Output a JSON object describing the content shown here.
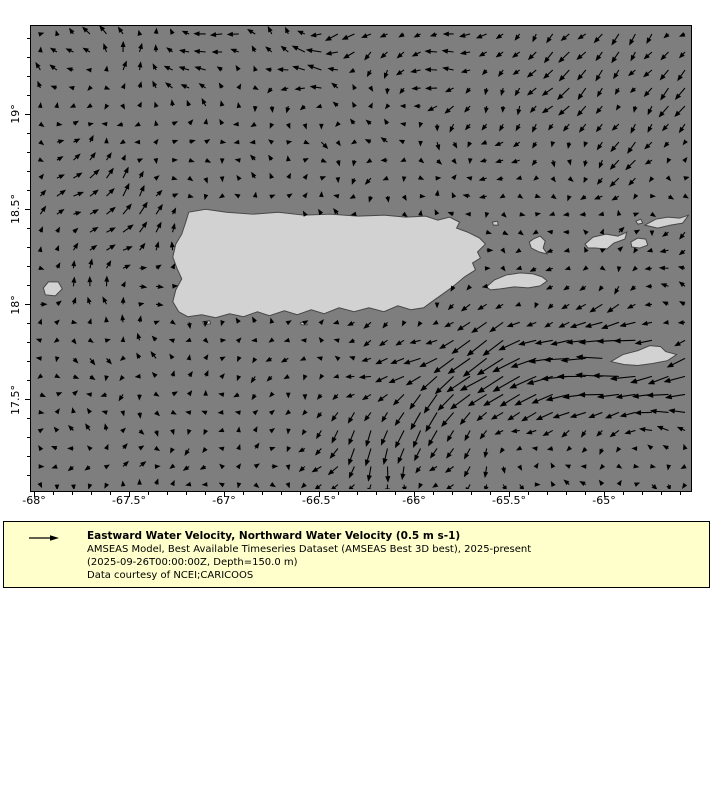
{
  "figure": {
    "width": 720,
    "height": 800,
    "background": "#ffffff"
  },
  "map": {
    "ocean_color": "#7e7e7e",
    "land_color": "#d2d2d2",
    "land_edge_color": "#474747",
    "frame_color": "#000000",
    "left": 30,
    "top": 25,
    "width": 660,
    "height": 465
  },
  "legend": {
    "background": "#ffffcc",
    "border_color": "#000000",
    "arrow_icon": "quiver-reference-arrow",
    "title": "Eastward Water Velocity, Northward Water Velocity (0.5 m s-1)",
    "lines": [
      "AMSEAS Model, Best Available Timeseries Dataset (AMSEAS Best 3D best), 2025-present",
      "(2025-09-26T00:00:00Z, Depth=150.0 m)",
      "Data courtesy of NCEI;CARICOOS"
    ]
  },
  "chart_data": {
    "type": "quiver-map",
    "projection": "lon-lat",
    "x_range": [
      -68.05,
      -64.55
    ],
    "y_range": [
      17.02,
      19.46
    ],
    "reference_vector": "0.5 m s-1",
    "arrow_color": "#000000",
    "x_axis": {
      "major_ticks": [
        {
          "label": "-68°",
          "px": 3
        },
        {
          "label": "-67.5°",
          "px": 98
        },
        {
          "label": "-67°",
          "px": 193
        },
        {
          "label": "-66.5°",
          "px": 288
        },
        {
          "label": "-66°",
          "px": 383
        },
        {
          "label": "-65.5°",
          "px": 478
        },
        {
          "label": "-65°",
          "px": 573
        }
      ],
      "minor_step": 19,
      "minor_start": 3,
      "major_len": 5,
      "minor_len": 3
    },
    "y_axis": {
      "major_ticks": [
        {
          "label": "19°",
          "px": 88
        },
        {
          "label": "18.5°",
          "px": 183
        },
        {
          "label": "18°",
          "px": 279
        },
        {
          "label": "17.5°",
          "px": 374
        }
      ],
      "minor_step": 19,
      "minor_start": 12,
      "major_len": 5,
      "minor_len": 3
    },
    "grid": {
      "x0": 9,
      "y0": 8,
      "dx": 16.6,
      "dy": 18.1,
      "cols": 40,
      "rows": 26
    },
    "flow_features": [
      {
        "name": "north-westward-band",
        "cx": 280,
        "cy": 22,
        "sx": 150,
        "sy": 34,
        "u": -9,
        "v": 0.5
      },
      {
        "name": "northeast-sw-flow",
        "cx": 590,
        "cy": 60,
        "sx": 120,
        "sy": 65,
        "u": -6.5,
        "v": 9
      },
      {
        "name": "northwest-northward",
        "cx": 125,
        "cy": 28,
        "sx": 70,
        "sy": 32,
        "u": 0.5,
        "v": -6.5
      },
      {
        "name": "mona-passage-ne",
        "cx": 85,
        "cy": 205,
        "sx": 55,
        "sy": 50,
        "u": 6,
        "v": -8.5
      },
      {
        "name": "west-eastward",
        "cx": 42,
        "cy": 168,
        "sx": 40,
        "sy": 26,
        "u": 5,
        "v": -0.5
      },
      {
        "name": "caribbean-westward-jet",
        "cx": 545,
        "cy": 342,
        "sx": 135,
        "sy": 30,
        "u": -23,
        "v": 2.5
      },
      {
        "name": "jet-southward-feed",
        "cx": 448,
        "cy": 352,
        "sx": 48,
        "sy": 55,
        "u": -5,
        "v": 13
      },
      {
        "name": "south-central-outflow",
        "cx": 352,
        "cy": 424,
        "sx": 52,
        "sy": 40,
        "u": -6,
        "v": 14
      },
      {
        "name": "southeast-westward",
        "cx": 604,
        "cy": 384,
        "sx": 78,
        "sy": 24,
        "u": -9,
        "v": 1
      },
      {
        "name": "east-mid-westward",
        "cx": 598,
        "cy": 282,
        "sx": 80,
        "sy": 38,
        "u": -5.5,
        "v": 2
      }
    ],
    "noise": {
      "amp1": 3.1,
      "amp2": 2.1,
      "jitter": 2.6,
      "min_len": 2.6,
      "max_len": 30
    },
    "land_polygons": [
      {
        "name": "puerto-rico",
        "mask": true,
        "points": [
          [
            158,
            187
          ],
          [
            175,
            184
          ],
          [
            196,
            187
          ],
          [
            222,
            189
          ],
          [
            248,
            187
          ],
          [
            274,
            190
          ],
          [
            300,
            189
          ],
          [
            328,
            191
          ],
          [
            354,
            190
          ],
          [
            376,
            192
          ],
          [
            396,
            191
          ],
          [
            408,
            195
          ],
          [
            420,
            192
          ],
          [
            430,
            197
          ],
          [
            427,
            203
          ],
          [
            438,
            207
          ],
          [
            450,
            213
          ],
          [
            456,
            219
          ],
          [
            448,
            227
          ],
          [
            451,
            233
          ],
          [
            443,
            238
          ],
          [
            446,
            245
          ],
          [
            435,
            252
          ],
          [
            423,
            262
          ],
          [
            412,
            270
          ],
          [
            402,
            277
          ],
          [
            394,
            283
          ],
          [
            381,
            285
          ],
          [
            368,
            281
          ],
          [
            354,
            287
          ],
          [
            339,
            283
          ],
          [
            324,
            287
          ],
          [
            309,
            283
          ],
          [
            294,
            289
          ],
          [
            281,
            285
          ],
          [
            267,
            290
          ],
          [
            254,
            286
          ],
          [
            239,
            291
          ],
          [
            227,
            287
          ],
          [
            213,
            292
          ],
          [
            199,
            289
          ],
          [
            185,
            293
          ],
          [
            171,
            290
          ],
          [
            157,
            292
          ],
          [
            148,
            287
          ],
          [
            142,
            277
          ],
          [
            145,
            265
          ],
          [
            151,
            254
          ],
          [
            146,
            243
          ],
          [
            142,
            232
          ],
          [
            145,
            219
          ],
          [
            151,
            209
          ],
          [
            155,
            197
          ]
        ]
      },
      {
        "name": "vieques",
        "mask": true,
        "points": [
          [
            457,
            262
          ],
          [
            465,
            255
          ],
          [
            477,
            250
          ],
          [
            491,
            248
          ],
          [
            504,
            249
          ],
          [
            513,
            252
          ],
          [
            518,
            256
          ],
          [
            511,
            261
          ],
          [
            499,
            263
          ],
          [
            485,
            262
          ],
          [
            471,
            264
          ],
          [
            461,
            265
          ]
        ]
      },
      {
        "name": "culebra",
        "mask": true,
        "points": [
          [
            504,
            214
          ],
          [
            511,
            211
          ],
          [
            516,
            216
          ],
          [
            514,
            223
          ],
          [
            518,
            229
          ],
          [
            510,
            227
          ],
          [
            502,
            223
          ],
          [
            500,
            217
          ]
        ]
      },
      {
        "name": "st-thomas",
        "mask": true,
        "points": [
          [
            556,
            219
          ],
          [
            564,
            212
          ],
          [
            577,
            209
          ],
          [
            589,
            211
          ],
          [
            598,
            207
          ],
          [
            596,
            214
          ],
          [
            585,
            218
          ],
          [
            578,
            224
          ],
          [
            566,
            223
          ],
          [
            559,
            223
          ]
        ]
      },
      {
        "name": "st-john",
        "mask": true,
        "points": [
          [
            602,
            217
          ],
          [
            609,
            213
          ],
          [
            617,
            214
          ],
          [
            619,
            220
          ],
          [
            611,
            223
          ],
          [
            603,
            222
          ]
        ]
      },
      {
        "name": "tortola",
        "mask": true,
        "points": [
          [
            616,
            200
          ],
          [
            627,
            194
          ],
          [
            639,
            192
          ],
          [
            651,
            193
          ],
          [
            660,
            190
          ],
          [
            654,
            198
          ],
          [
            642,
            200
          ],
          [
            629,
            203
          ]
        ]
      },
      {
        "name": "virgin-gorda",
        "mask": false,
        "points": [
          [
            662,
            193
          ],
          [
            669,
            188
          ],
          [
            673,
            194
          ],
          [
            667,
            198
          ]
        ]
      },
      {
        "name": "jost-van-dyke",
        "mask": false,
        "points": [
          [
            607,
            196
          ],
          [
            612,
            194
          ],
          [
            614,
            198
          ],
          [
            609,
            199
          ]
        ]
      },
      {
        "name": "st-croix",
        "mask": true,
        "points": [
          [
            582,
            337
          ],
          [
            594,
            330
          ],
          [
            609,
            326
          ],
          [
            621,
            321
          ],
          [
            632,
            322
          ],
          [
            637,
            327
          ],
          [
            648,
            330
          ],
          [
            639,
            336
          ],
          [
            624,
            339
          ],
          [
            609,
            341
          ],
          [
            595,
            340
          ]
        ]
      },
      {
        "name": "mona",
        "mask": true,
        "points": [
          [
            12,
            263
          ],
          [
            17,
            257
          ],
          [
            27,
            257
          ],
          [
            31,
            264
          ],
          [
            24,
            271
          ],
          [
            14,
            270
          ]
        ]
      },
      {
        "name": "caja-de-muertos",
        "mask": false,
        "points": [
          [
            172,
            297
          ],
          [
            179,
            296
          ],
          [
            180,
            299
          ],
          [
            173,
            300
          ]
        ]
      },
      {
        "name": "south-islet",
        "mask": false,
        "points": [
          [
            270,
            298
          ],
          [
            276,
            297
          ],
          [
            277,
            300
          ],
          [
            271,
            300
          ]
        ]
      },
      {
        "name": "fajardo-islet",
        "mask": false,
        "points": [
          [
            463,
            197
          ],
          [
            468,
            196
          ],
          [
            469,
            200
          ],
          [
            464,
            200
          ]
        ]
      }
    ]
  }
}
